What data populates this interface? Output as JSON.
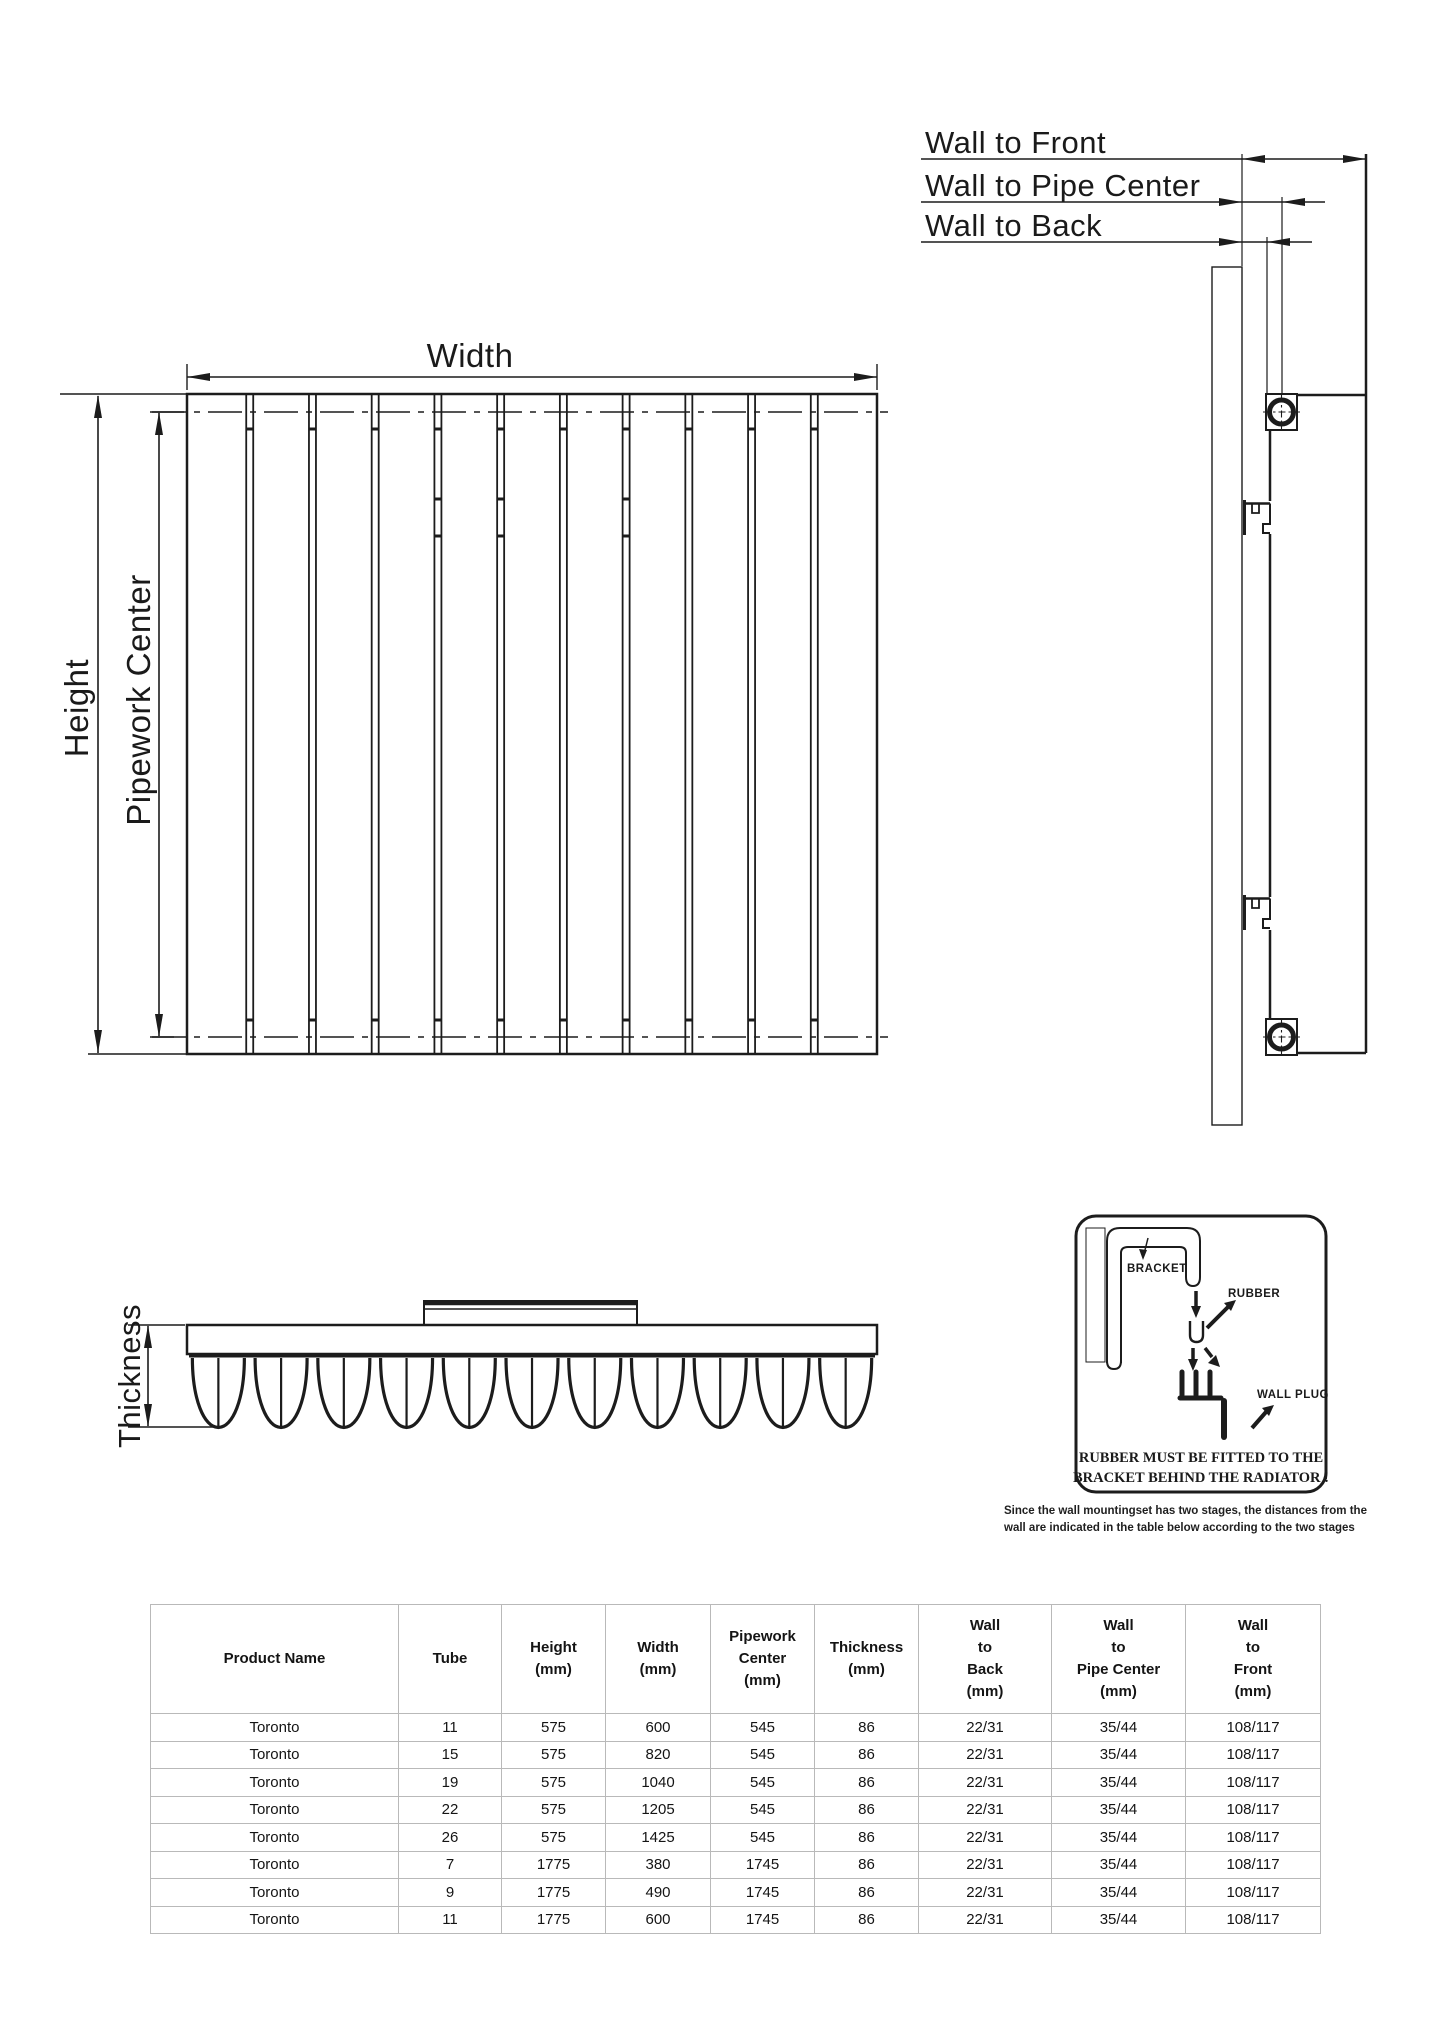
{
  "drawing": {
    "front_view": {
      "width_label": "Width",
      "height_label": "Height",
      "pipework_center_label": "Pipework Center"
    },
    "top_view": {
      "thickness_label": "Thickness"
    },
    "side_view": {
      "wall_to_front_label": "Wall to Front",
      "wall_to_pipe_center_label": "Wall to Pipe Center",
      "wall_to_back_label": "Wall to Back"
    }
  },
  "detail_box": {
    "radiator_label": "RADIATOR",
    "bracket_label": "BRACKET",
    "rubber_label": "RUBBER",
    "wall_plug_label": "WALL PLUG",
    "warning_line1": "RUBBER MUST BE FITTED TO THE",
    "warning_line2": "BRACKET BEHIND THE RADIATOR !"
  },
  "note": {
    "line1": "Since the wall mountingset has two stages, the distances from the",
    "line2": "wall are indicated in the table below according to the two stages"
  },
  "table": {
    "headers": [
      {
        "lines": [
          "Product Name"
        ]
      },
      {
        "lines": [
          "Tube"
        ]
      },
      {
        "lines": [
          "Height",
          "(mm)"
        ]
      },
      {
        "lines": [
          "Width",
          "(mm)"
        ]
      },
      {
        "lines": [
          "Pipework",
          "Center",
          "(mm)"
        ]
      },
      {
        "lines": [
          "Thickness",
          "(mm)"
        ]
      },
      {
        "lines": [
          "Wall",
          "to",
          "Back",
          "(mm)"
        ]
      },
      {
        "lines": [
          "Wall",
          "to",
          "Pipe Center",
          "(mm)"
        ]
      },
      {
        "lines": [
          "Wall",
          "to",
          "Front",
          "(mm)"
        ]
      }
    ],
    "rows": [
      [
        "Toronto",
        "11",
        "575",
        "600",
        "545",
        "86",
        "22/31",
        "35/44",
        "108/117"
      ],
      [
        "Toronto",
        "15",
        "575",
        "820",
        "545",
        "86",
        "22/31",
        "35/44",
        "108/117"
      ],
      [
        "Toronto",
        "19",
        "575",
        "1040",
        "545",
        "86",
        "22/31",
        "35/44",
        "108/117"
      ],
      [
        "Toronto",
        "22",
        "575",
        "1205",
        "545",
        "86",
        "22/31",
        "35/44",
        "108/117"
      ],
      [
        "Toronto",
        "26",
        "575",
        "1425",
        "545",
        "86",
        "22/31",
        "35/44",
        "108/117"
      ],
      [
        "Toronto",
        "7",
        "1775",
        "380",
        "1745",
        "86",
        "22/31",
        "35/44",
        "108/117"
      ],
      [
        "Toronto",
        "9",
        "1775",
        "490",
        "1745",
        "86",
        "22/31",
        "35/44",
        "108/117"
      ],
      [
        "Toronto",
        "11",
        "1775",
        "600",
        "1745",
        "86",
        "22/31",
        "35/44",
        "108/117"
      ]
    ]
  },
  "colors": {
    "line": "#1c1c1c",
    "wall_hatch": "#c2c2c2",
    "wall_outline": "#a8a8a8",
    "table_border": "#b9b9b9",
    "detail_bar": "#3f3f3f",
    "background": "#ffffff"
  }
}
